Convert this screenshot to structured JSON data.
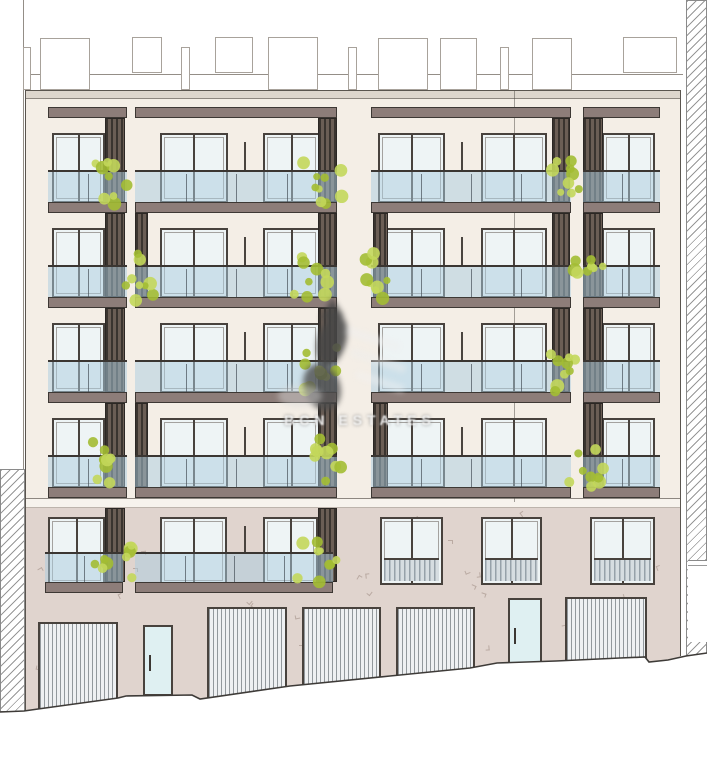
{
  "watermark": {
    "text": "BCN ESTATES"
  },
  "palette": {
    "cream": "#f4eee6",
    "parapet": "#ddd6cd",
    "band": "#f7f3ed",
    "stone": "#e0d4ce",
    "slab": "#8d7d79",
    "slab_edge": "#3d3834",
    "frame": "#48423d",
    "glass": "#eef4f5",
    "glass_tint": "rgba(170,204,224,0.5)",
    "rail_line": "#3b3632",
    "mullion": "rgba(70,80,88,0.7)",
    "louver_dark": "#3a342f",
    "louver_light": "#6b5e55",
    "plant_green_1": "#a3bd33",
    "plant_green_2": "#c3d75b",
    "garage_fill": "#eef0f2",
    "garage_stripe": "rgba(130,136,141,0.85)",
    "door_glass": "#dff0f2",
    "hatch_line": "rgba(125,125,125,0.8)",
    "stone_mark": "#b1a098",
    "roof_box_edge": "#a8a29b",
    "edge_line": "#5a554f",
    "thin_line": "#948e87",
    "ground_line": "#3e3b38",
    "watermark_dark": "#474747",
    "ground_louver_stripe": "#96a1a9",
    "ground_louver_bg": "#d6dde1"
  },
  "roof": {
    "rail_line_y": 74,
    "boxes": [
      [
        23,
        47,
        8,
        43
      ],
      [
        40,
        38,
        50,
        52
      ],
      [
        132,
        37,
        30,
        36
      ],
      [
        181,
        47,
        9,
        43
      ],
      [
        215,
        37,
        38,
        36
      ],
      [
        268,
        37,
        50,
        53
      ],
      [
        348,
        47,
        9,
        43
      ],
      [
        378,
        38,
        50,
        52
      ],
      [
        440,
        38,
        37,
        52
      ],
      [
        500,
        47,
        9,
        43
      ],
      [
        532,
        38,
        40,
        52
      ],
      [
        623,
        37,
        54,
        36
      ]
    ]
  },
  "building": {
    "left": 25,
    "right": 681,
    "parapet_y": 90,
    "parapet_h": 9,
    "cream_y": 99,
    "cream_h": 399,
    "band_y": 498,
    "band_h": 10,
    "stone_y": 508,
    "stone_h": 210,
    "joint_x": 514,
    "boundary_x": 23,
    "boundary_len": 469
  },
  "floors": {
    "slab_h": 11,
    "canopy_y": 107,
    "upper_segs": [
      [
        48,
        79
      ],
      [
        135,
        202
      ],
      [
        371,
        200
      ],
      [
        583,
        77
      ]
    ],
    "rows": [
      {
        "win_y": 133,
        "rail_y": 170,
        "slab_y": 202,
        "windows": [
          [
            52,
            53
          ],
          [
            160,
            68
          ],
          [
            263,
            57
          ],
          [
            378,
            67
          ],
          [
            481,
            66
          ],
          [
            602,
            53
          ]
        ]
      },
      {
        "win_y": 228,
        "rail_y": 265,
        "slab_y": 297,
        "windows": [
          [
            52,
            53
          ],
          [
            160,
            68
          ],
          [
            263,
            57
          ],
          [
            378,
            67
          ],
          [
            481,
            66
          ],
          [
            602,
            53
          ]
        ]
      },
      {
        "win_y": 323,
        "rail_y": 360,
        "slab_y": 392,
        "windows": [
          [
            52,
            53
          ],
          [
            160,
            68
          ],
          [
            263,
            57
          ],
          [
            378,
            67
          ],
          [
            481,
            66
          ],
          [
            602,
            53
          ]
        ]
      },
      {
        "win_y": 418,
        "rail_y": 455,
        "slab_y": 487,
        "windows": [
          [
            52,
            53
          ],
          [
            160,
            68
          ],
          [
            263,
            57
          ],
          [
            378,
            67
          ],
          [
            481,
            66
          ],
          [
            602,
            53
          ]
        ]
      }
    ],
    "row5": {
      "win_y": 517,
      "win_h": 68,
      "rail_y": 552,
      "slab_y": 582,
      "windows": [
        [
          48,
          57
        ],
        [
          160,
          67
        ],
        [
          263,
          55
        ]
      ],
      "rail_segs": [
        [
          45,
          78
        ],
        [
          135,
          198
        ]
      ],
      "louvered_windows": [
        [
          380,
          63
        ],
        [
          481,
          61
        ],
        [
          590,
          65
        ]
      ],
      "louver_split": 39
    }
  },
  "louvers": [
    {
      "x": 105,
      "w": 20,
      "segs": [
        [
          118,
          84
        ],
        [
          213,
          84
        ],
        [
          308,
          84
        ],
        [
          403,
          84
        ],
        [
          508,
          74
        ]
      ]
    },
    {
      "x": 135,
      "w": 13,
      "segs": [
        [
          213,
          84
        ],
        [
          403,
          84
        ]
      ]
    },
    {
      "x": 318,
      "w": 19,
      "segs": [
        [
          118,
          84
        ],
        [
          213,
          84
        ],
        [
          308,
          84
        ],
        [
          403,
          84
        ],
        [
          508,
          74
        ]
      ]
    },
    {
      "x": 373,
      "w": 15,
      "segs": [
        [
          213,
          84
        ],
        [
          403,
          84
        ]
      ]
    },
    {
      "x": 552,
      "w": 18,
      "segs": [
        [
          118,
          84
        ],
        [
          213,
          84
        ],
        [
          308,
          84
        ]
      ]
    },
    {
      "x": 583,
      "w": 20,
      "segs": [
        [
          118,
          84
        ],
        [
          213,
          84
        ],
        [
          308,
          84
        ],
        [
          403,
          84
        ]
      ]
    }
  ],
  "posts": [
    {
      "x": 245,
      "rows": [
        0,
        1,
        2,
        3,
        4
      ]
    },
    {
      "x": 462,
      "rows": [
        0,
        1,
        2,
        3
      ]
    }
  ],
  "plants": [
    [
      93,
      160,
      40,
      46
    ],
    [
      300,
      157,
      42,
      47
    ],
    [
      545,
      155,
      38,
      46
    ],
    [
      121,
      253,
      36,
      48
    ],
    [
      290,
      251,
      48,
      50
    ],
    [
      356,
      252,
      34,
      52
    ],
    [
      568,
      255,
      36,
      42
    ],
    [
      300,
      347,
      40,
      46
    ],
    [
      545,
      350,
      30,
      42
    ],
    [
      93,
      438,
      38,
      48
    ],
    [
      306,
      437,
      42,
      48
    ],
    [
      566,
      444,
      38,
      44
    ],
    [
      93,
      537,
      42,
      50
    ],
    [
      290,
      537,
      48,
      46
    ]
  ],
  "ground_floor": {
    "garages": [
      [
        38,
        622,
        80,
        92
      ],
      [
        207,
        607,
        80,
        95
      ],
      [
        302,
        607,
        79,
        86
      ],
      [
        396,
        607,
        79,
        78
      ],
      [
        565,
        597,
        82,
        70
      ]
    ],
    "doors": [
      [
        143,
        625,
        30,
        71
      ],
      [
        508,
        598,
        34,
        70
      ]
    ],
    "grille": [
      0,
      611,
      10,
      36
    ],
    "ground_pts": "0,712 24,711 38,709 118,698 126,696 192,695 200,699 290,686 390,676 470,668 497,663 556,661 620,658 645,657 649,662 668,660 686,656 707,653"
  },
  "neighbors": {
    "left_section": [
      0,
      469,
      25,
      243
    ],
    "right_section": [
      686,
      0,
      21,
      658
    ],
    "right_notch": [
      688,
      560,
      19,
      82
    ]
  }
}
